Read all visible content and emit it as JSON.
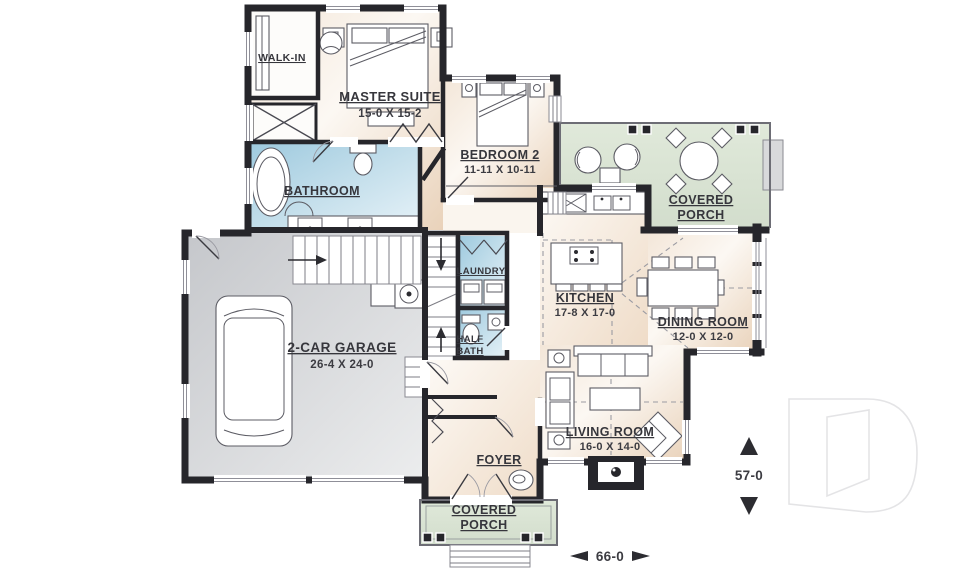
{
  "rooms": {
    "walk_in": {
      "label": "WALK-IN"
    },
    "master_suite": {
      "label": "MASTER SUITE",
      "dims": "15-0 X 15-2"
    },
    "bedroom_2": {
      "label": "BEDROOM 2",
      "dims": "11-11 X 10-11"
    },
    "bathroom": {
      "label": "BATHROOM"
    },
    "covered_porch_rear": {
      "line1": "COVERED",
      "line2": "PORCH"
    },
    "laundry": {
      "label": "LAUNDRY"
    },
    "half_bath": {
      "line1": "HALF",
      "line2": "BATH"
    },
    "kitchen": {
      "label": "KITCHEN",
      "dims": "17-8 X 17-0"
    },
    "dining_room": {
      "label": "DINING ROOM",
      "dims": "12-0 X 12-0"
    },
    "garage": {
      "label": "2-CAR GARAGE",
      "dims": "26-4 X 24-0"
    },
    "living_room": {
      "label": "LIVING ROOM",
      "dims": "16-0 X 14-0"
    },
    "foyer": {
      "label": "FOYER"
    },
    "covered_porch_front": {
      "line1": "COVERED",
      "line2": "PORCH"
    }
  },
  "dimensions": {
    "overall_depth": "57-0",
    "overall_width": "66-0"
  },
  "icons": {
    "logo": "drummond-d-logo",
    "depth_arrows": "up-down-triangles",
    "width_arrows": "left-right-triangles"
  },
  "colors": {
    "walls": "#26262b",
    "room_tint": "#e9d2ba",
    "wet_room_tint": "#9dc9de",
    "porch_tint": "#dae4d4",
    "garage_tint": "#c9cbcf",
    "label_text": "#36363c"
  }
}
